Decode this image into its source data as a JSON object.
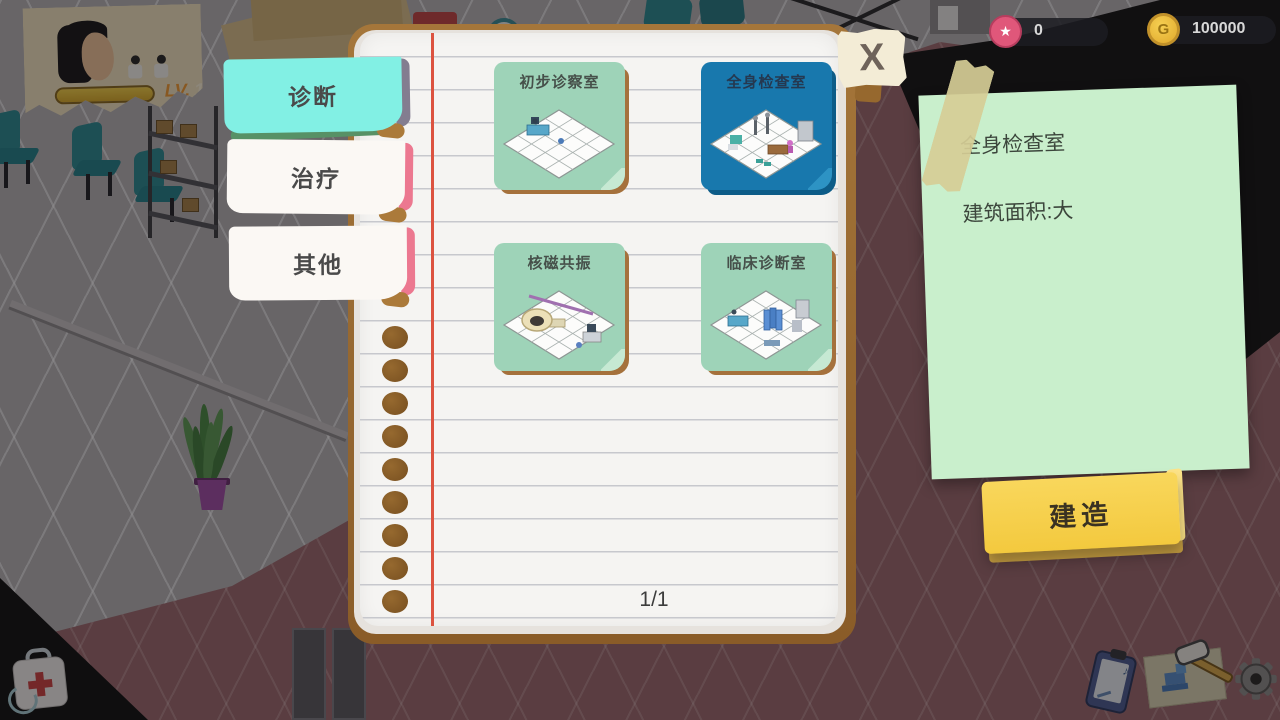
{
  "hud": {
    "level": {
      "label": "LV.",
      "value": "1"
    },
    "currencies": [
      {
        "name": "stars",
        "value": "0"
      },
      {
        "name": "coins",
        "value": "100000",
        "symbol": "G"
      }
    ]
  },
  "icons": {
    "star": "★",
    "music_note": "♪"
  },
  "tabs": [
    {
      "label": "诊断",
      "active": true
    },
    {
      "label": "治疗",
      "active": false
    },
    {
      "label": "其他",
      "active": false
    }
  ],
  "notebook": {
    "close_label": "X",
    "page_indicator": "1/1",
    "cards": [
      {
        "label": "初步诊察室",
        "selected": false
      },
      {
        "label": "全身检查室",
        "selected": true
      },
      {
        "label": "核磁共振",
        "selected": false
      },
      {
        "label": "临床诊断室",
        "selected": false
      }
    ]
  },
  "detail_panel": {
    "title": "全身检查室",
    "area_info": "建筑面积:大",
    "build_label": "建造"
  },
  "colors": {
    "card_selected": "#1878ad",
    "card_default": "#9ed3b8",
    "tab_active": "#82f0e4",
    "note_bg": "#c9efcc",
    "build_bg": "#f8d24f",
    "coin": "#f0c040",
    "star_badge": "#e0577a"
  }
}
